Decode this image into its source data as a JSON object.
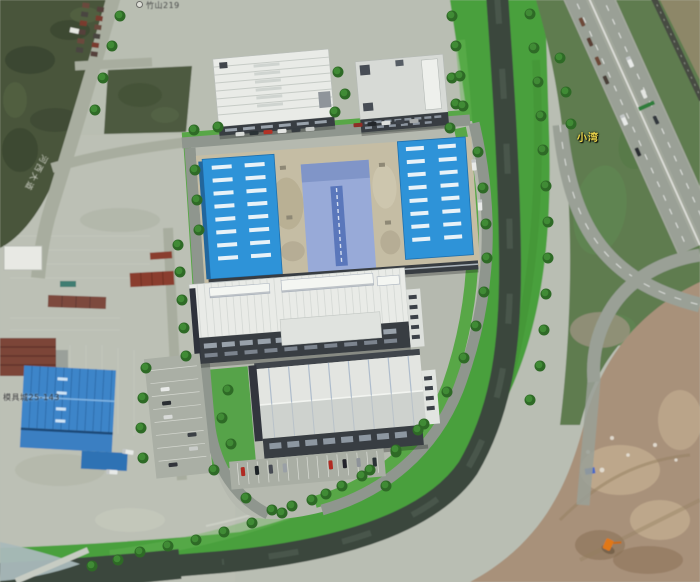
{
  "scene_description": "Satellite aerial view with a 3D rendering of an industrial park campus: two white warehouses at top, a large blue-roofed factory complex in the middle, two big gray-roofed halls below, parking lots with cars, tree-lined perimeter roads, a river curving around the site, a highway interchange on the right and a dirt construction area at bottom right; container storage yard and a blue warehouse at left.",
  "labels": {
    "place_bay": "小湾",
    "poi_top_left": "竹山219",
    "poi_bottom_left": "模具城25-143",
    "road_name": "河西大道"
  },
  "colors": {
    "ground-gray": "#b9beb3",
    "yard-gray": "#bcc0b5",
    "field-dark": "#48553b",
    "scrub-dark": "#4d5a40",
    "lawn-green": "#4aa03c",
    "lawn-light": "#66b554",
    "river-dark": "#3b473e",
    "water-light": "#a9b9ba",
    "road-gray": "#a8ad9f",
    "campus-road": "#8f968e",
    "highway-gray": "#9aa096",
    "grass-olive": "#5e7b50",
    "dirt-brown": "#a8917a",
    "dirt-light": "#c6b093",
    "white-roof": "#e9ebe7",
    "gray-roof": "#d7dad6",
    "blue-roof": "#2f93d8",
    "blue-dash": "#e8f2f8",
    "center-roof": "#98aad8",
    "center-ridge": "#5a77bb",
    "plinth-beige": "#c5bda4",
    "facade-dark": "#373c43",
    "window-light": "#99a2ab",
    "tree-dark": "#2f6b28",
    "tree-light": "#449138",
    "container-red": "#8a3c2e",
    "brick-red": "#7b4438",
    "blue-warehouse": "#3c85c9",
    "label-yellow": "#ead54b",
    "poi-dark": "#2b2b2e",
    "road-label-white": "#e9e9e2",
    "excavator-orange": "#e07818",
    "sign-green": "#2e7d3a"
  }
}
